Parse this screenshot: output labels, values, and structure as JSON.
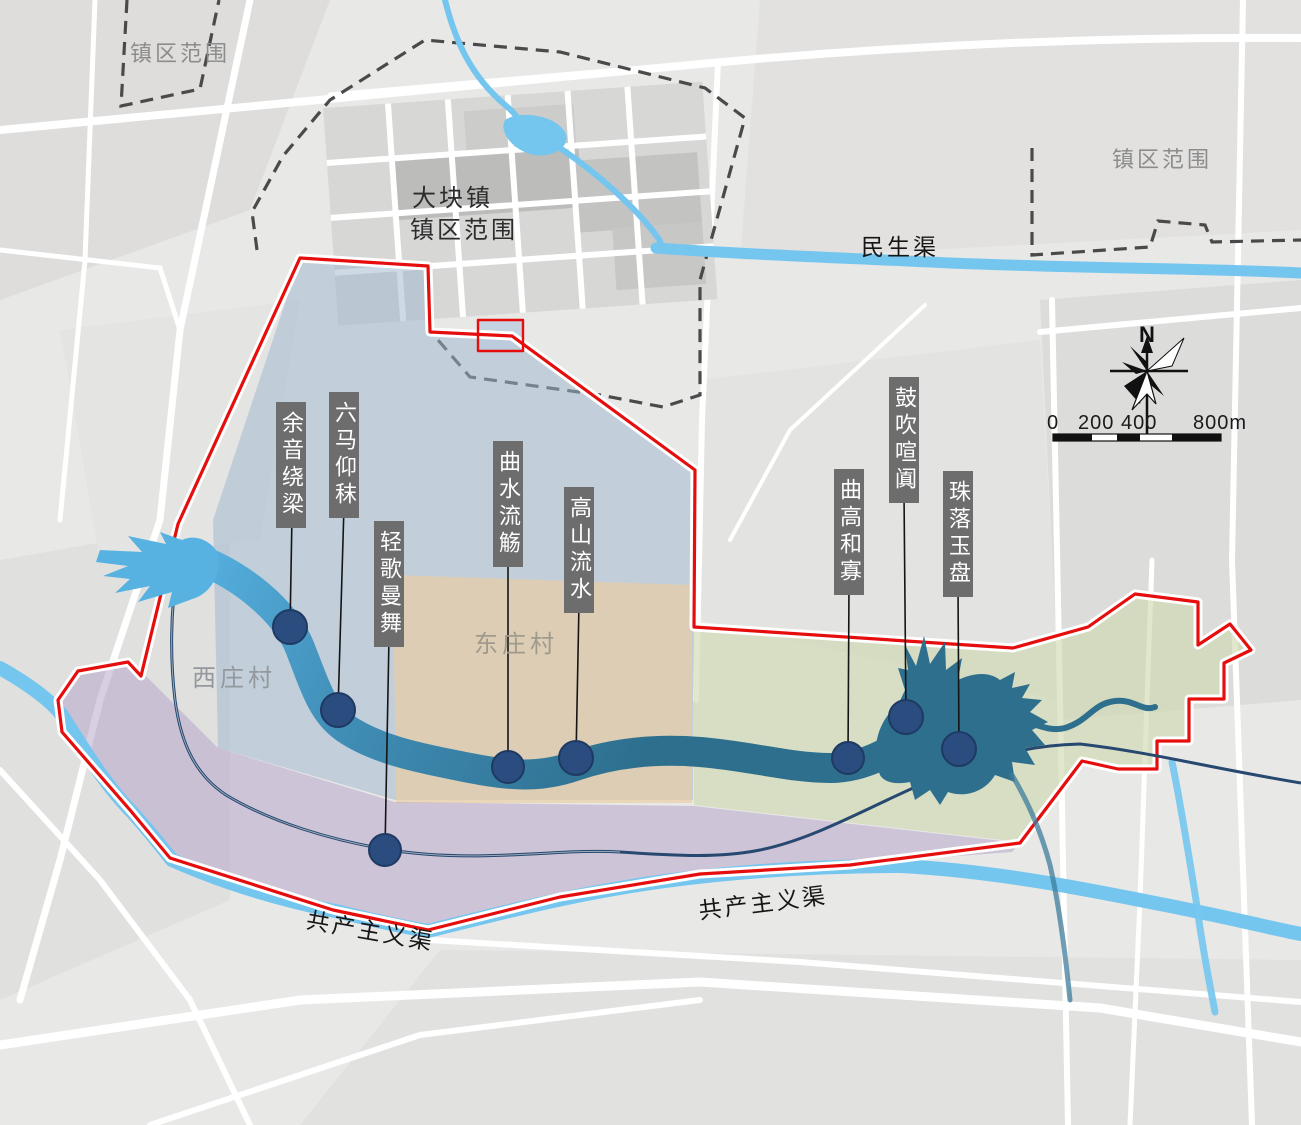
{
  "boundary_labels": {
    "top_left": "镇区范围",
    "top_right": "镇区范围",
    "town_line1": "大块镇",
    "town_line2": "镇区范围"
  },
  "canal_labels": {
    "minsheng": "民生渠",
    "gongchanzhuyi_west": "共产主义渠",
    "gongchanzhuyi_east": "共产主义渠"
  },
  "village_labels": {
    "west": "西庄村",
    "east": "东庄村"
  },
  "compass": {
    "north": "N"
  },
  "scale_bar": {
    "t0": "0",
    "t200": "200",
    "t400": "400",
    "t800": "800m"
  },
  "poi_markers": [
    {
      "label": "余音绕梁"
    },
    {
      "label": "六马仰秣"
    },
    {
      "label": "轻歌曼舞"
    },
    {
      "label": "曲水流觞"
    },
    {
      "label": "高山流水"
    },
    {
      "label": "曲高和寡"
    },
    {
      "label": "鼓吹喧阗"
    },
    {
      "label": "珠落玉盘"
    }
  ],
  "colors": {
    "boundary_red": "#e60d0d",
    "dashed_boundary": "#4a4a4a",
    "canal_blue": "#74c6ef",
    "river_light": "#57b2e2",
    "river_dark": "#2e6f8e",
    "zone_blue": "#9fb9d0",
    "zone_orange": "#eccc9c",
    "zone_green": "#cdd9ae",
    "zone_purple": "#b4a0c8",
    "marker_navy": "#2a4c7e",
    "poi_label_bg": "#6d6d6d"
  }
}
